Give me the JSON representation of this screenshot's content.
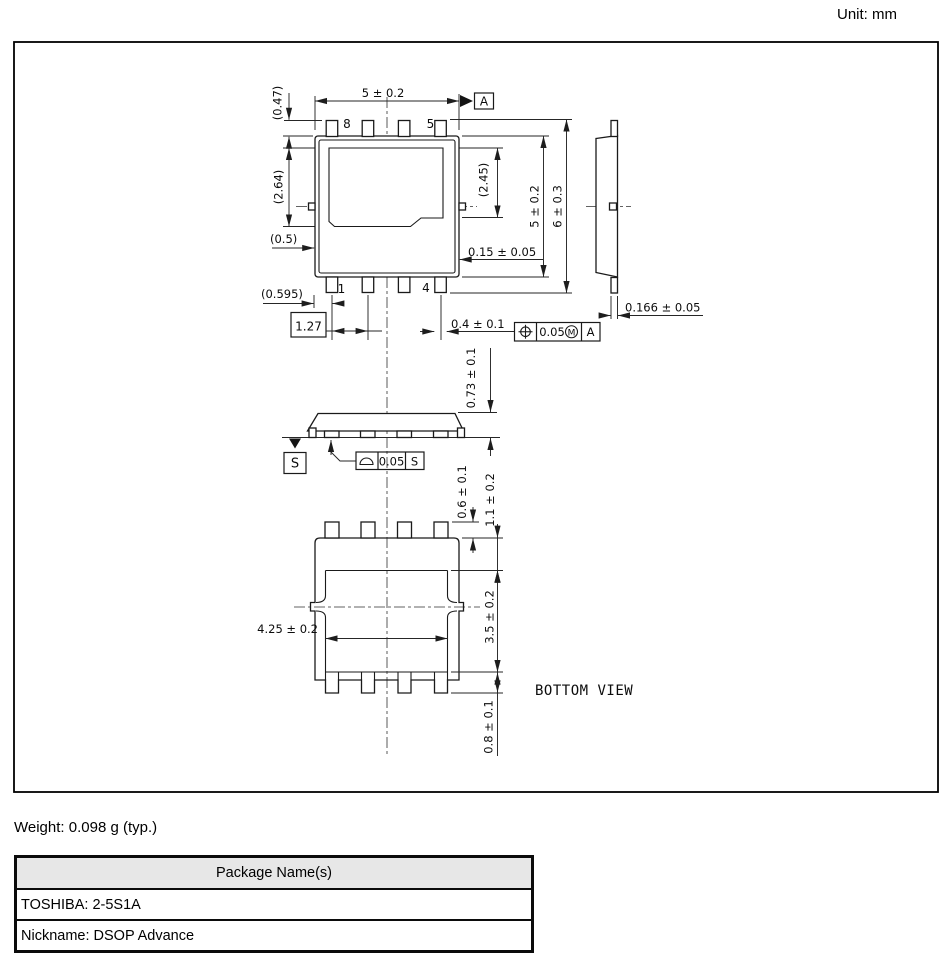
{
  "unit_label": "Unit: mm",
  "weight_label": "Weight: 0.098 g (typ.)",
  "package_table": {
    "header": "Package Name(s)",
    "rows": [
      "TOSHIBA: 2-5S1A",
      "Nickname: DSOP Advance"
    ]
  },
  "drawing": {
    "bottom_view_label": "BOTTOM VIEW",
    "pins": {
      "top_left": "8",
      "top_right": "5",
      "bottom_left": "1",
      "bottom_right": "4"
    },
    "dims": {
      "body_width": "5 ± 0.2",
      "pin_protrusion": "(0.47)",
      "pad_height": "(2.64)",
      "pad_height_right": "(2.45)",
      "pad_side_offset": "(0.5)",
      "pad_width": "(4)",
      "edge_step": "0.15 ± 0.05",
      "edge_to_pin1": "(0.595)",
      "pin_pitch": "1.27",
      "lead_width": "0.4 ± 0.1",
      "body_length": "5 ± 0.2",
      "overall_length": "6 ± 0.3",
      "lead_thickness": "0.166 ± 0.05",
      "body_height": "0.73 ± 0.1",
      "lead_length_bottom": "0.6 ± 0.1",
      "pad_edge_offset": "1.1 ± 0.2",
      "pad_length_bottom": "3.5 ± 0.2",
      "pad_width_bottom": "4.25 ± 0.2",
      "pad_tab_length": "0.8 ± 0.1"
    },
    "gdt": {
      "datum_a": "A",
      "datum_s": "S",
      "position_tolerance": "0.05",
      "material_modifier": "M",
      "position_datum": "A",
      "profile_tolerance": "0.05",
      "profile_datum": "S"
    },
    "colors": {
      "line": "#1a1a1a",
      "table_header_bg": "#e7e7e7"
    }
  }
}
